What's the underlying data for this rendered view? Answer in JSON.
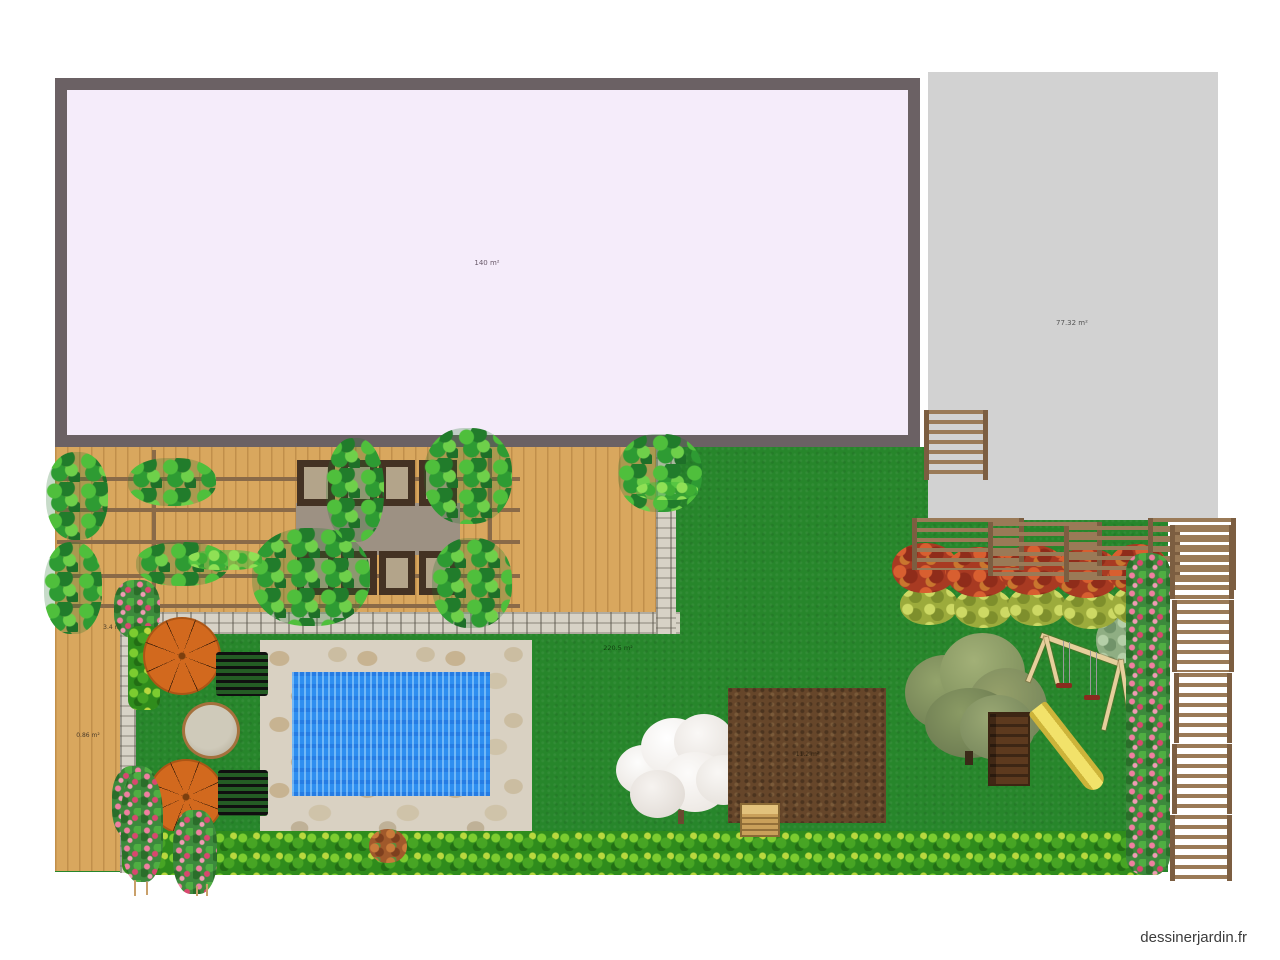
{
  "watermark": {
    "text": "dessinerjardin.fr"
  },
  "labels": {
    "house": "140 m²",
    "terrace": "77.32 m²",
    "lawn": "220.5 m²",
    "pergola_bed": "3.4 m²",
    "deck": "0.86 m²",
    "vegetable_patch": "11.2 m²"
  },
  "colors": {
    "house_fill": "#f5ecfa",
    "house_border": "#6b6164",
    "terrace_fill": "#d2d2d2",
    "lawn_green": "#27862b",
    "deck_wood": "#d9a75e",
    "pool_water": "#2e8ef0",
    "pool_paving": "#d9d1c2",
    "parasol_orange": "#d2691e",
    "soil_brown": "#66462a",
    "slide_yellow": "#f2e26a",
    "fence_wood": "#9a7a57",
    "watermark_text": "#3c3c3c"
  },
  "elements": [
    "house",
    "paved-terrace",
    "lawn",
    "wood-deck",
    "pergola",
    "vine-plant",
    "stone-wall",
    "swimming-pool",
    "parasol",
    "sun-lounger",
    "gravel-circle",
    "flower-hedge",
    "rose-bush",
    "flowering-tree",
    "vegetable-patch",
    "compost-crate",
    "large-tree",
    "swing-set",
    "slide",
    "autumn-hedge",
    "wood-fence",
    "climbing-roses"
  ]
}
